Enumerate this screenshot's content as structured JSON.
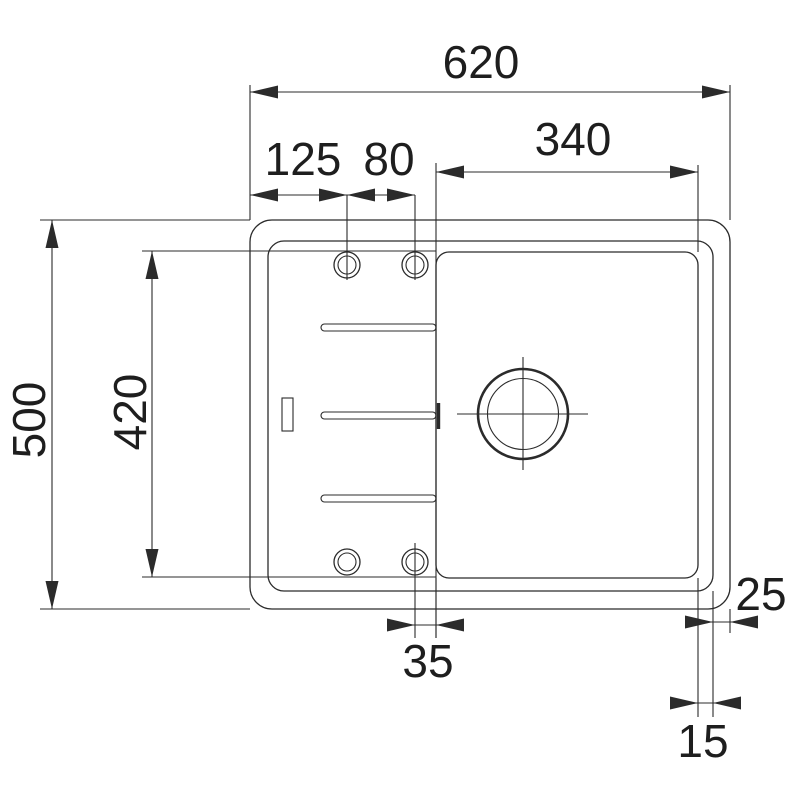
{
  "drawing": {
    "type": "technical-dimension-drawing",
    "subject": "kitchen sink top view with drainer board and single bowl",
    "units": "mm",
    "colors": {
      "line": "#2b2b2b",
      "text": "#1e1e1e",
      "background": "#ffffff"
    },
    "dims": {
      "overall_width": "620",
      "bowl_width": "340",
      "tap_hole_left_offset": "125",
      "tap_hole_spacing": "80",
      "overall_depth": "500",
      "inner_depth": "420",
      "hole_to_bowl_offset": "35",
      "rim_to_edge_right": "25",
      "bowl_to_rim_right": "15"
    }
  }
}
